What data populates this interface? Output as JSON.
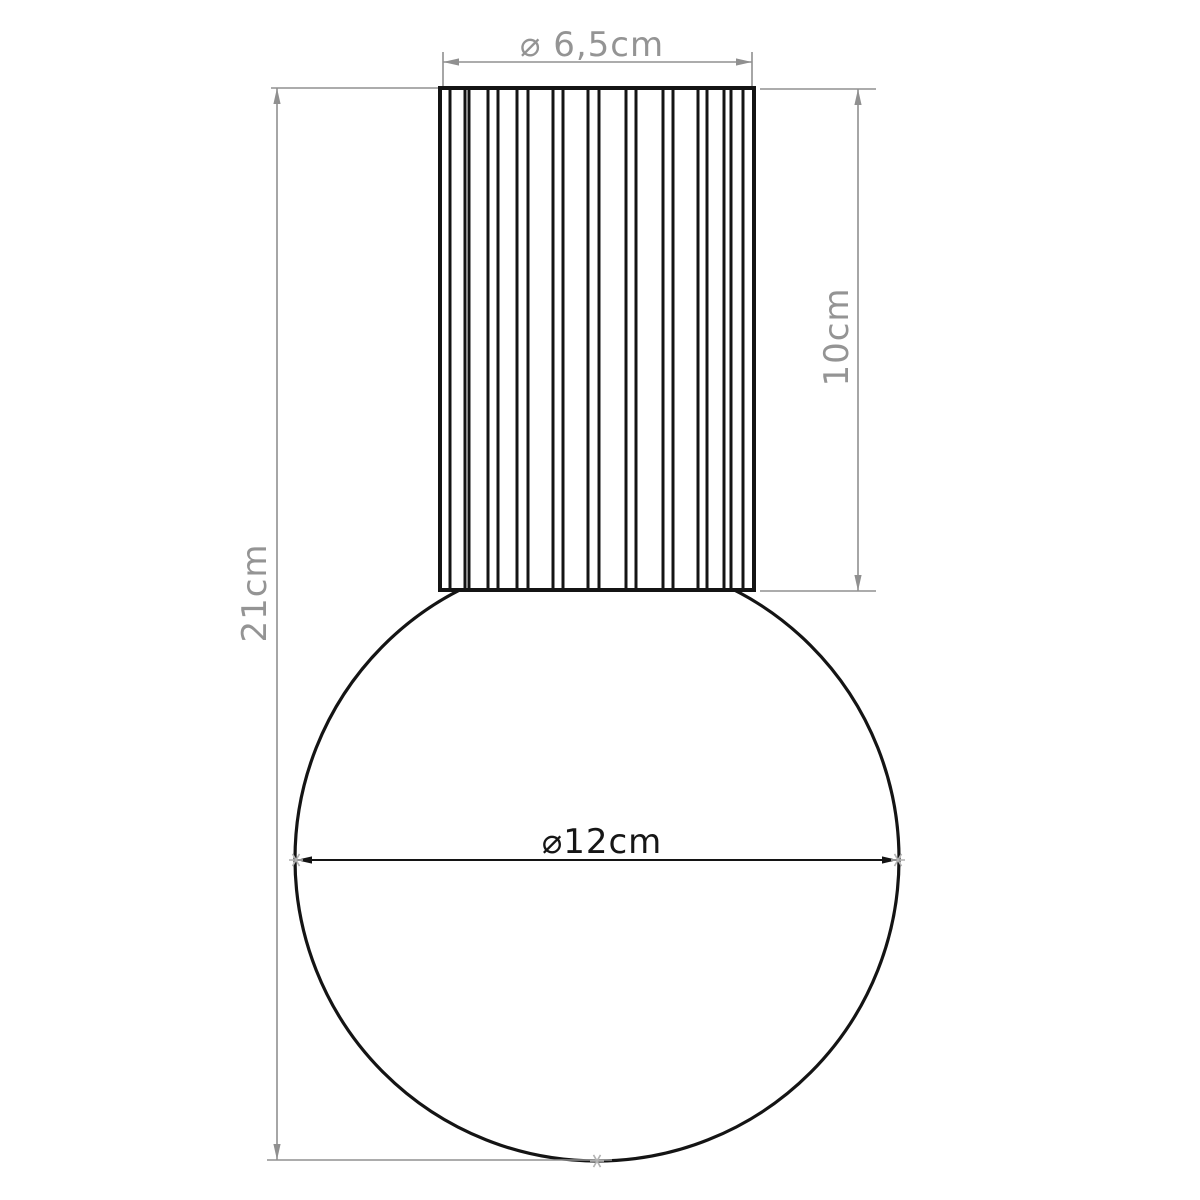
{
  "drawing_title": "lamp-dimension-drawing",
  "labels": {
    "top_diameter": "⌀ 6,5cm",
    "cylinder_height": "10cm",
    "total_height": "21cm",
    "sphere_diameter": "⌀12cm"
  },
  "dimensions_cm": {
    "cylinder_diameter": 6.5,
    "cylinder_height": 10,
    "total_height": 21,
    "sphere_diameter": 12
  },
  "colors": {
    "background": "#ffffff",
    "object_line": "#141414",
    "dimension_line": "#909090",
    "dimension_text": "#949494",
    "point_marker": "#b3b3b3"
  },
  "figure": {
    "width": 1200,
    "height": 1200,
    "cylinder": {
      "x1": 440,
      "x2": 754,
      "y1": 88,
      "y2": 590,
      "ribs": [
        450,
        465,
        469,
        488,
        498,
        517,
        528,
        553,
        563,
        588,
        599,
        626,
        636,
        663,
        673,
        698,
        707,
        724,
        731,
        743
      ]
    },
    "sphere": {
      "cx": 597,
      "cy": 859,
      "r": 302
    },
    "dim_top": {
      "y": 62,
      "x1": 443,
      "x2": 752,
      "ext_y1": 52,
      "ext_y2": 86
    },
    "dim_right": {
      "x": 858,
      "y1": 89,
      "y2": 591,
      "ext_top": {
        "y": 89,
        "x1": 760,
        "x2": 876
      },
      "ext_bot": {
        "y": 591,
        "x1": 760,
        "x2": 876
      }
    },
    "dim_left": {
      "x": 277,
      "y1": 88,
      "y2": 1160,
      "ext_top": {
        "y": 88,
        "x1": 271,
        "x2": 438
      },
      "ext_bot": {
        "y": 1160,
        "x1": 267,
        "x2": 612
      }
    },
    "dim_sphere": {
      "y": 860,
      "x1": 296,
      "x2": 898
    },
    "markers": [
      [
        296,
        860
      ],
      [
        898,
        860
      ],
      [
        597,
        1161
      ]
    ]
  }
}
